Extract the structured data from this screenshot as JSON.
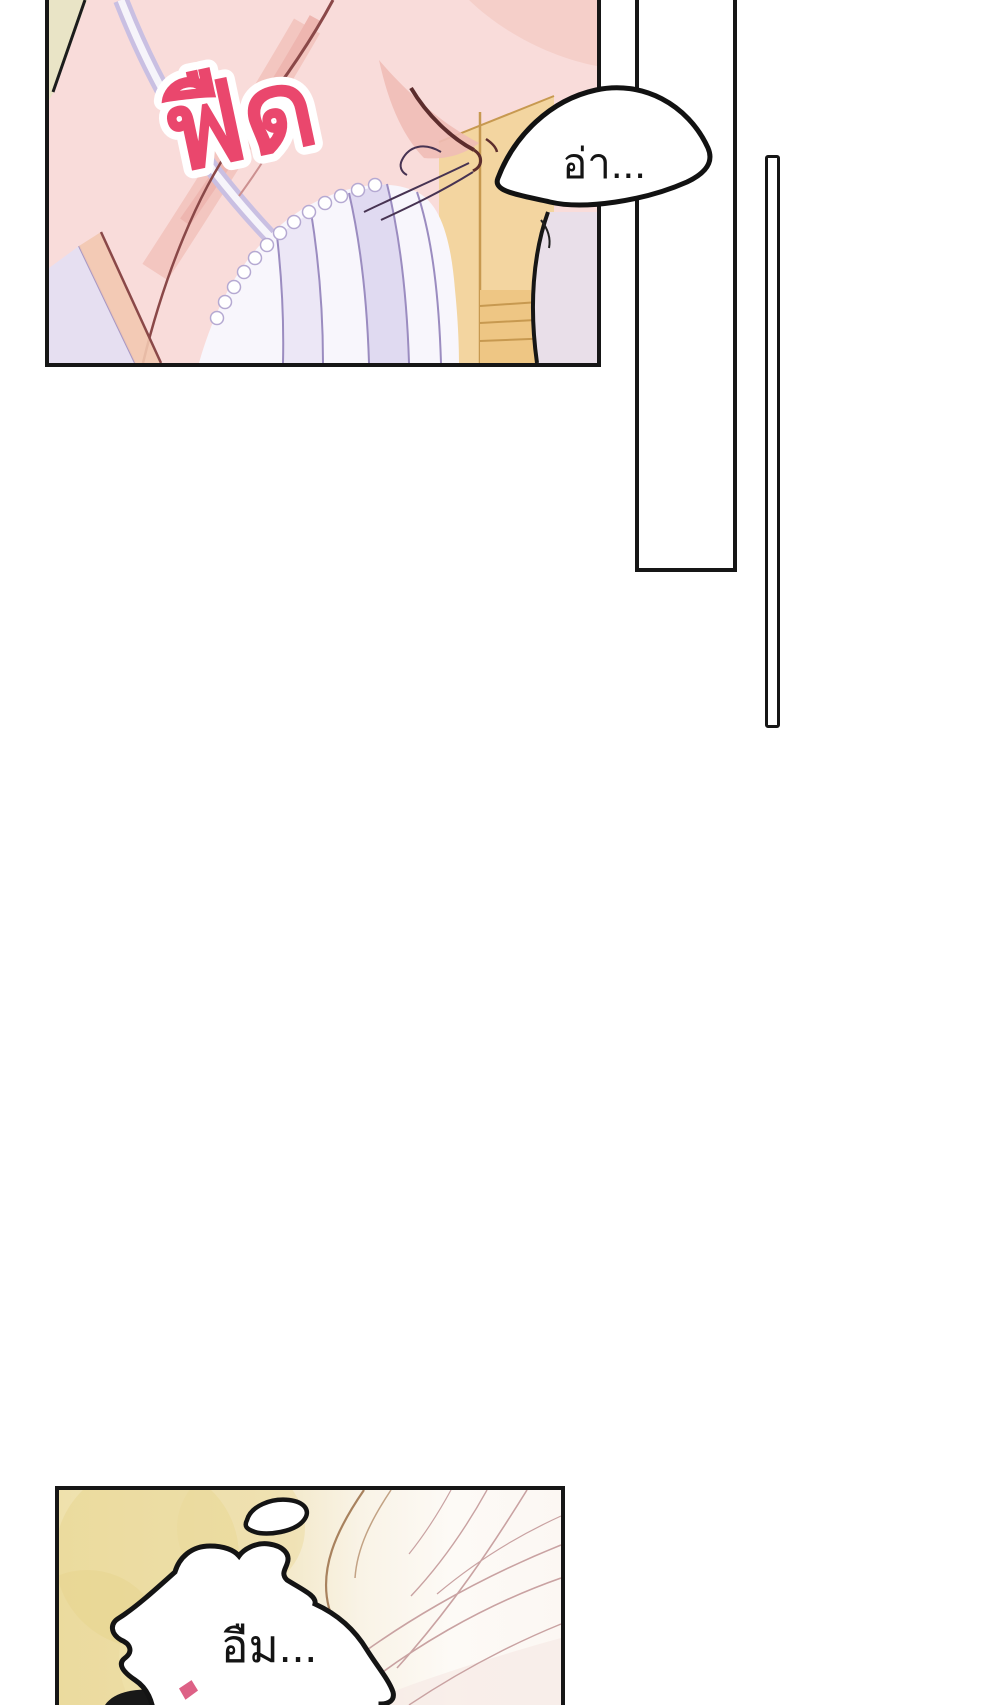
{
  "page": {
    "width_px": 1000,
    "height_px": 1705,
    "background_color": "#ffffff"
  },
  "top_panel": {
    "sfx_snap": {
      "text": "ฟืด",
      "fill_color": "#ea476d",
      "outline_color": "#ffffff"
    },
    "colors": {
      "skin": "#f9dcda",
      "skin_shadow": "#f3c6c0",
      "line_art": "#8a4848",
      "corner_wall": "#e9e4c6",
      "strap": "#c9bfe2",
      "camisole": "#f8f6fc",
      "camisole_fold": "#dcd5ee",
      "lace_trim": "#ffffff",
      "wardrobe_wood": "#f3d5a0",
      "wood_line": "#c79950",
      "wall": "#e9dfe9"
    }
  },
  "speech_bubble_top": {
    "text": "อ่า...",
    "fill_color": "#ffffff",
    "outline_color": "#121212"
  },
  "tall_rectangle_panel": {
    "fill_color": "#ffffff",
    "border_color": "#161616"
  },
  "vertical_pole": {
    "fill_color": "#ffffff",
    "border_color": "#161616"
  },
  "bottom_panel": {
    "speech_bubble": {
      "text": "อืม...",
      "fill_color": "#ffffff",
      "outline_color": "#141414"
    },
    "sfx_fragment_color": "#dd6186",
    "colors": {
      "bedding_cream": "#efe1ac",
      "bedding_gold": "#e8d58f",
      "drape_line": "#c9a2a2",
      "pillow_line": "#a8825e",
      "hair": "#181818"
    }
  }
}
